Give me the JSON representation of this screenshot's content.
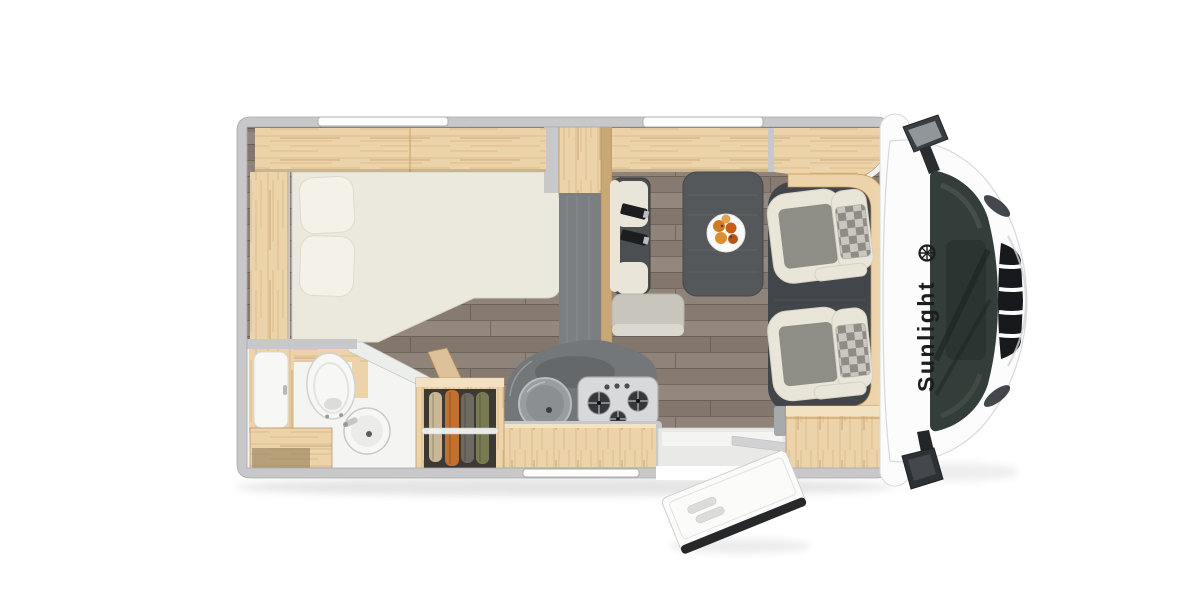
{
  "brand": {
    "label": "Sunlight",
    "logo": "sunlight-sun-badge"
  },
  "view": {
    "type": "motorhome-floorplan-top-view"
  },
  "fixtures": [
    "overhead-lockers",
    "roof-window",
    "french-bed",
    "pillows",
    "side-shelf",
    "bathroom",
    "toilet",
    "washbasin",
    "shower-cabinet",
    "vanity-cabinet",
    "wardrobe",
    "kitchen-block",
    "round-sink",
    "gas-hob",
    "tall-cabinet-fridge",
    "worktop",
    "dinette-table",
    "fruit-plate",
    "travel-bench-seat",
    "seat-belts",
    "cab-seat-left",
    "cab-seat-right",
    "entrance-door",
    "entry-step",
    "sideboard",
    "cab-body",
    "windshield",
    "front-grille",
    "wing-mirror-top",
    "wing-mirror-bottom"
  ],
  "colors": {
    "wall": "#c8c8ca",
    "wall_edge": "#a9a9ab",
    "body_white": "#fcfcfd",
    "body_outline": "#d8d8da",
    "wood": "#ecd3aa",
    "wood_dark": "#c9a878",
    "wood_door": "#dcc19a",
    "floor": "#8e8176",
    "mattress": "#ebe9de",
    "pillow": "#f3f1e8",
    "bath_floor": "#f4f4f2",
    "fixture_white": "#f7f7f5",
    "counter": "#7b7f82",
    "worktop": "#73777a",
    "stove_panel": "#d8d9da",
    "burner": "#35373a",
    "table": "#54585a",
    "plate": "#fbfbf9",
    "bench": "#4b4f51",
    "cushion": "#e9e5d9",
    "seat_panel": "#8f8e86",
    "seat_base": "#c8c6bc",
    "checker_light": "#c9c7c0",
    "checker_dark": "#8e8c85",
    "cab_floor": "#42464a",
    "windshield": "#333d39",
    "grille": "#17191c",
    "mirror": "#2e3134",
    "belt": "#1c1d1f",
    "entry_floor": "#e9e9e7",
    "door_edge": "#26282a",
    "clothes_beige": "#c9b795",
    "clothes_orange": "#c1702f",
    "clothes_grey": "#6e6a62",
    "clothes_olive": "#7a7a52",
    "fruit": "#cd701f",
    "brand_text": "#1d1d1b"
  }
}
